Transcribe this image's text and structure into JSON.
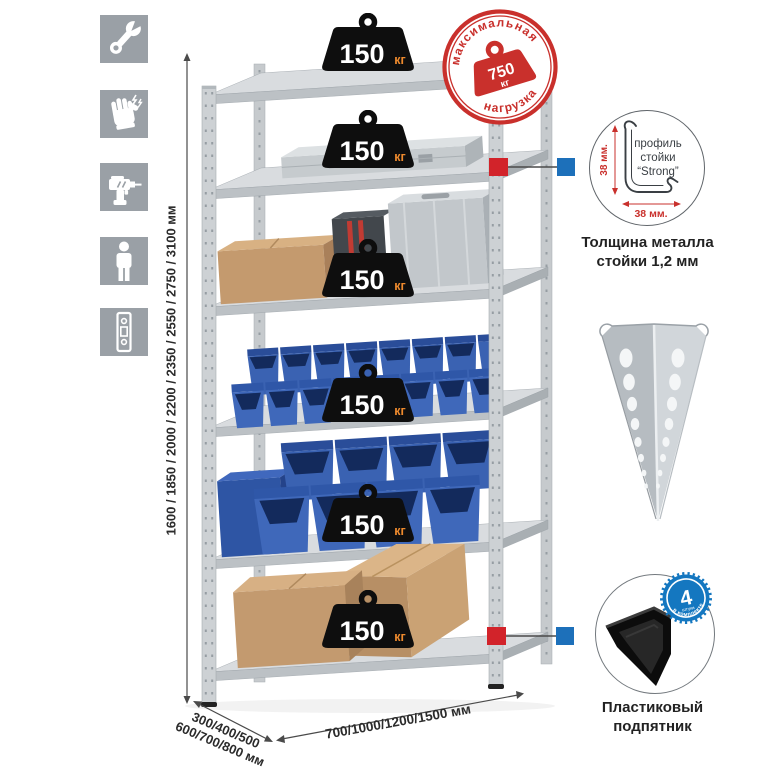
{
  "colors": {
    "accent_red": "#c9302c",
    "marker_red": "#d2232a",
    "marker_blue": "#1d70ba",
    "badge_blue": "#1477c0",
    "bin_blue": "#3a62b2",
    "metal_gray": "#c6cacd",
    "icon_gray": "#9aa0a6",
    "cardboard": "#c49a6e"
  },
  "icons_panel": {
    "items": [
      {
        "name": "wrench-icon"
      },
      {
        "name": "gloves-icon"
      },
      {
        "name": "drill-icon"
      },
      {
        "name": "person-height-icon"
      },
      {
        "name": "rack-post-icon"
      }
    ]
  },
  "rack": {
    "badge_unit": "кг",
    "shelves": [
      {
        "load": "150"
      },
      {
        "load": "150"
      },
      {
        "load": "150"
      },
      {
        "load": "150"
      },
      {
        "load": "150"
      },
      {
        "load": "150"
      }
    ]
  },
  "max_load_stamp": {
    "arc_top": "максимальная",
    "arc_bottom": "нагрузка",
    "value": "750",
    "unit": "кг"
  },
  "dimensions": {
    "height": "1600 / 1850 / 2000 / 2200 / 2350 / 2550 / 2750 / 3100 мм",
    "depth_line1": "300/400/500",
    "depth_line2": "600/700/800 мм",
    "width": "700/1000/1200/1500 мм"
  },
  "profile_detail": {
    "label_line1": "профиль",
    "label_line2": "стойки",
    "label_line3": "“Strong”",
    "dim_height": "38 мм.",
    "dim_width": "38 мм.",
    "caption_line1": "Толщина металла",
    "caption_line2": "стойки 1,2 мм"
  },
  "foot_detail": {
    "badge_value": "4",
    "badge_sub": "штуки",
    "badge_arc": "в комплекте",
    "caption_line1": "Пластиковый",
    "caption_line2": "подпятник"
  }
}
